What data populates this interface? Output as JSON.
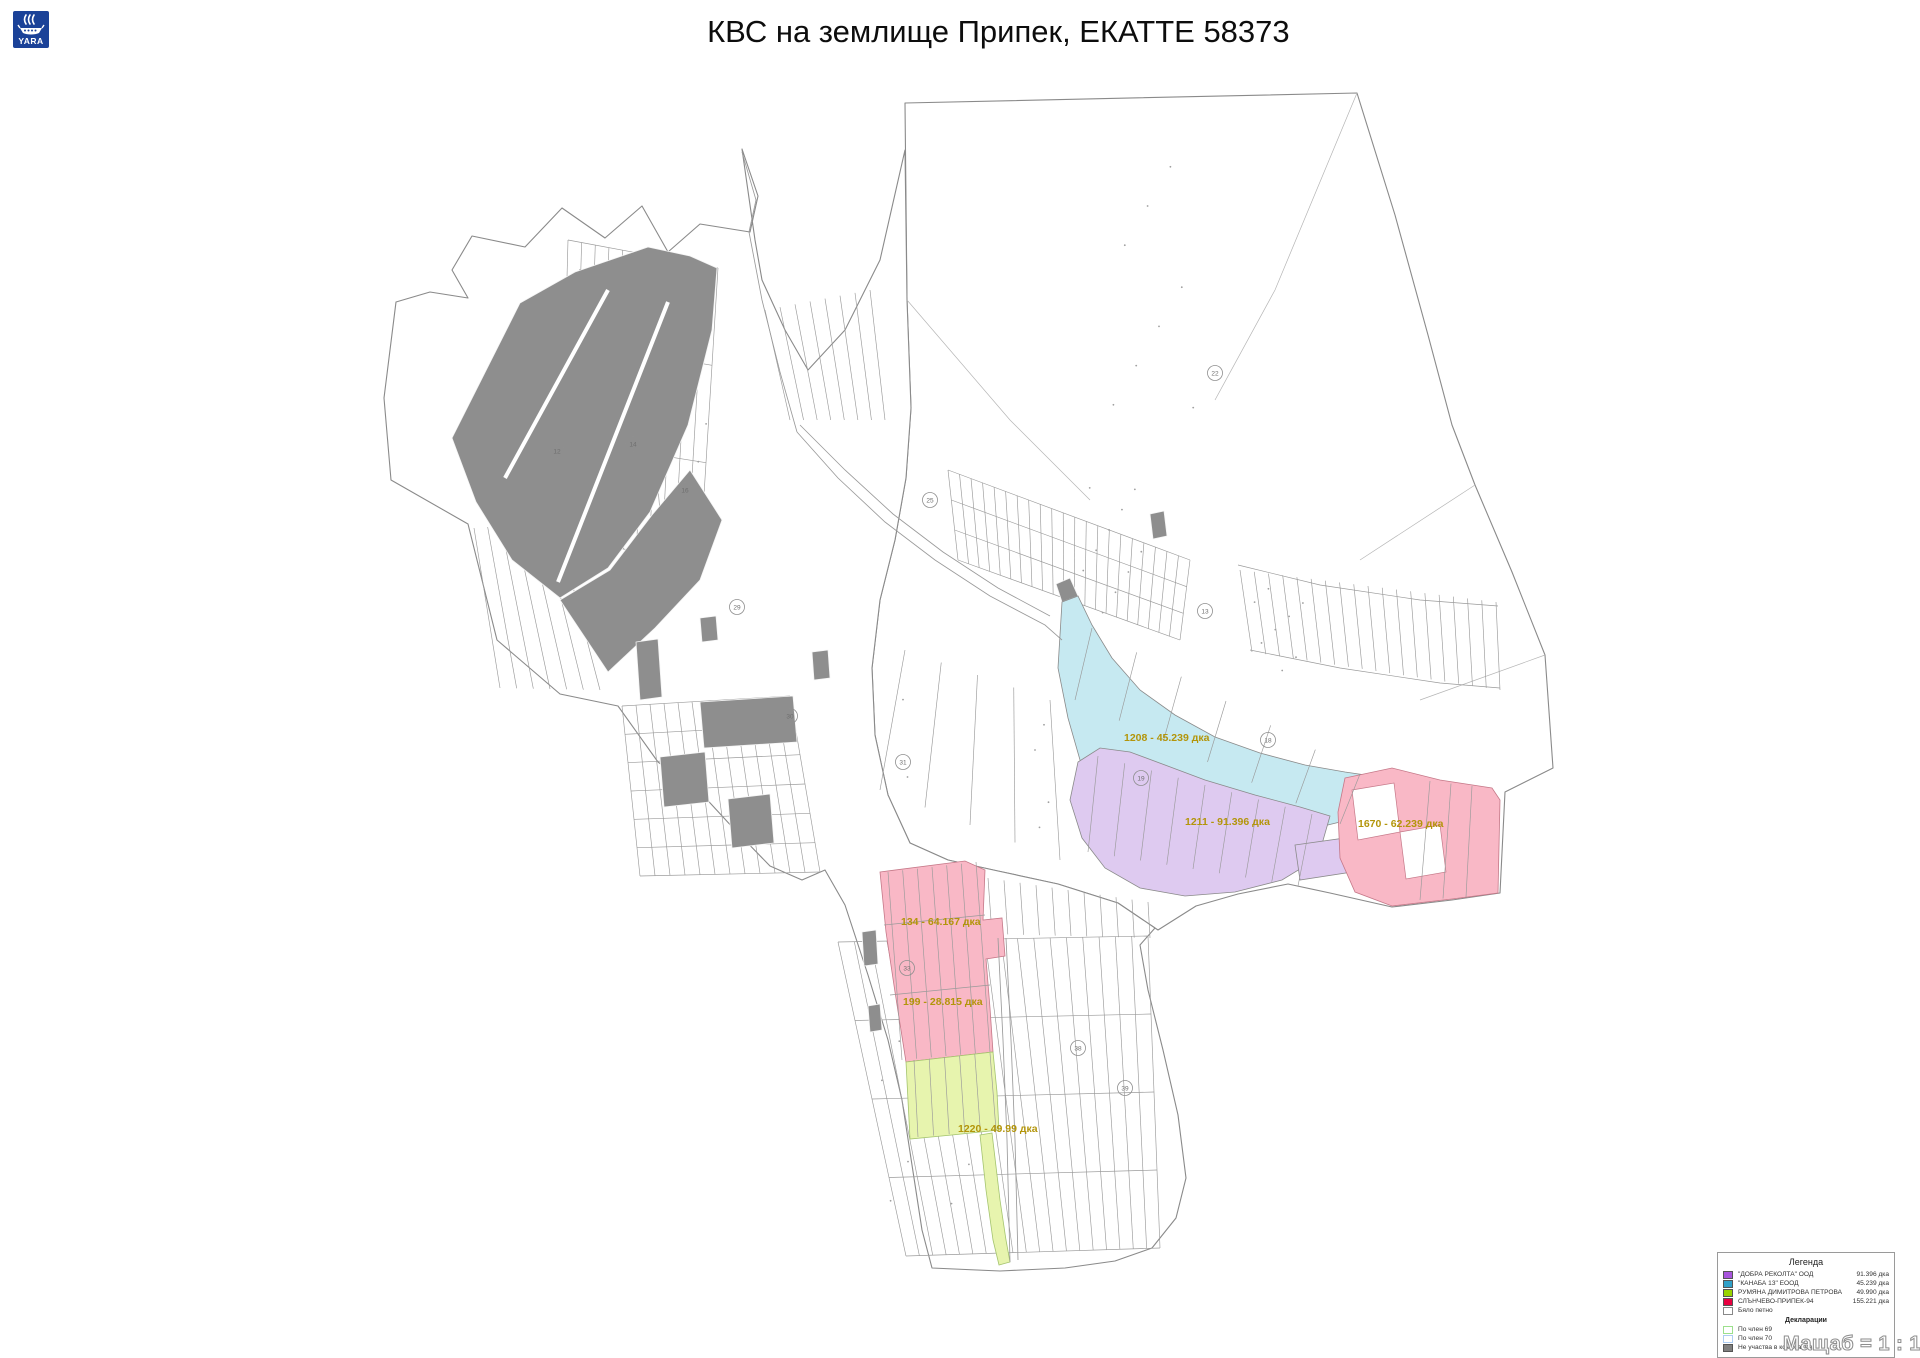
{
  "header": {
    "title": "КВС на землище Припек, ЕКАТТЕ 58373"
  },
  "logo": {
    "text": "YARA"
  },
  "footer": {
    "scale_label": "Мащаб = 1 : 1505"
  },
  "legend": {
    "title": "Легенда",
    "owners": [
      {
        "name": "\"ДОБРА РЕКОЛТА\" ООД",
        "area": "91.396 дка",
        "fill": "#a855dd",
        "border": "#555555"
      },
      {
        "name": "\"КАНАБА 13\" ЕООД",
        "area": "45.239 дка",
        "fill": "#30a0c8",
        "border": "#555555"
      },
      {
        "name": "РУМЯНА ДИМИТРОВА ПЕТРОВА",
        "area": "49.990 дка",
        "fill": "#98d400",
        "border": "#555555"
      },
      {
        "name": "СЛЪНЧЕВО-ПРИПЕК-94",
        "area": "155.221 дка",
        "fill": "#e80040",
        "border": "#555555"
      },
      {
        "name": "Бяло петно",
        "area": "",
        "fill": "#ffffff",
        "border": "#888888"
      }
    ],
    "declarations_title": "Декларации",
    "declarations": [
      {
        "name": "По член 69",
        "fill": "#ffffff",
        "border": "#9ce08c"
      },
      {
        "name": "По член 70",
        "fill": "#ffffff",
        "border": "#aecdf2"
      },
      {
        "name": "Не участва в комасация",
        "fill": "#7f7f7f",
        "border": "#555555"
      }
    ]
  },
  "map": {
    "parcel_labels": [
      {
        "text": "1208 - 45.239 дка",
        "x": 1124,
        "y": 741
      },
      {
        "text": "1211 - 91.396 дка",
        "x": 1185,
        "y": 825
      },
      {
        "text": "1670 - 62.239 дка",
        "x": 1358,
        "y": 827
      },
      {
        "text": "134 - 64.167 дка",
        "x": 901,
        "y": 925
      },
      {
        "text": "199 - 28.815 дка",
        "x": 903,
        "y": 1005
      },
      {
        "text": "1220 - 49.99 дка",
        "x": 958,
        "y": 1132
      }
    ],
    "masiv_numbers": [
      {
        "n": "12",
        "x": 557,
        "y": 451
      },
      {
        "n": "14",
        "x": 633,
        "y": 444
      },
      {
        "n": "16",
        "x": 685,
        "y": 490
      },
      {
        "n": "29",
        "x": 737,
        "y": 607
      },
      {
        "n": "30",
        "x": 790,
        "y": 716
      },
      {
        "n": "22",
        "x": 1215,
        "y": 373
      },
      {
        "n": "25",
        "x": 930,
        "y": 500
      },
      {
        "n": "13",
        "x": 1205,
        "y": 611
      },
      {
        "n": "18",
        "x": 1268,
        "y": 740
      },
      {
        "n": "19",
        "x": 1141,
        "y": 778
      },
      {
        "n": "31",
        "x": 903,
        "y": 762
      },
      {
        "n": "33",
        "x": 907,
        "y": 968
      },
      {
        "n": "38",
        "x": 1078,
        "y": 1048
      },
      {
        "n": "39",
        "x": 1125,
        "y": 1088
      }
    ]
  },
  "colors": {
    "map_gray": "#8e8e8e",
    "map_cyan": "#c6e9f1",
    "map_purple": "#decaf0",
    "map_pink": "#f9b8c6",
    "map_green": "#e7f4ae",
    "label_yellow": "#b3950a",
    "parcel_line": "#9a9a9a",
    "boundary": "#8a8a8a",
    "logo_blue": "#1b4298"
  }
}
